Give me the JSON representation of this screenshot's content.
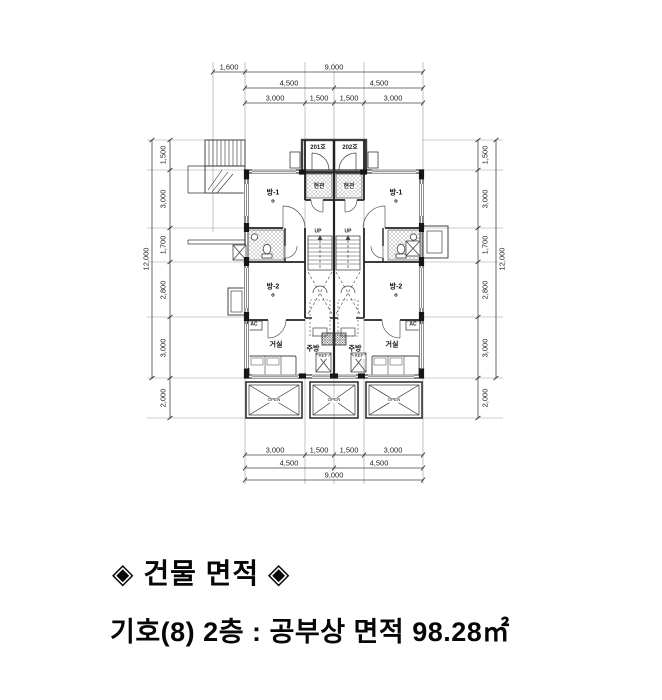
{
  "caption": {
    "title": "◈ 건물 면적 ◈",
    "subtitle": "기호(8) 2층 : 공부상 면적 98.28㎡"
  },
  "dims": {
    "top": {
      "stair_width": "1,600",
      "overall": "9,000",
      "half_left": "4,500",
      "half_right": "4,500",
      "seg1": "3,000",
      "seg2": "1,500",
      "seg3": "1,500",
      "seg4": "3,000"
    },
    "bottom": {
      "seg1": "3,000",
      "seg2": "1,500",
      "seg3": "1,500",
      "seg4": "3,000",
      "half_left": "4,500",
      "half_right": "4,500",
      "overall": "9,000"
    },
    "left": {
      "overall": "12,000",
      "chain": [
        "1,500",
        "3,000",
        "1,700",
        "2,800",
        "3,000",
        "2,000"
      ]
    },
    "right": {
      "overall": "12,000",
      "chain": [
        "1,500",
        "3,000",
        "1,700",
        "2,800",
        "3,000",
        "2,000"
      ]
    }
  },
  "rooms": {
    "unit_left_no": "201호",
    "unit_right_no": "202호",
    "entry": "현관",
    "room1": "방-1",
    "room2": "방-2",
    "living": "거실",
    "kitchen": "주방",
    "up": "UP",
    "ac": "AC",
    "ref": "REF",
    "open": "OPEN",
    "datum": "⊕"
  }
}
